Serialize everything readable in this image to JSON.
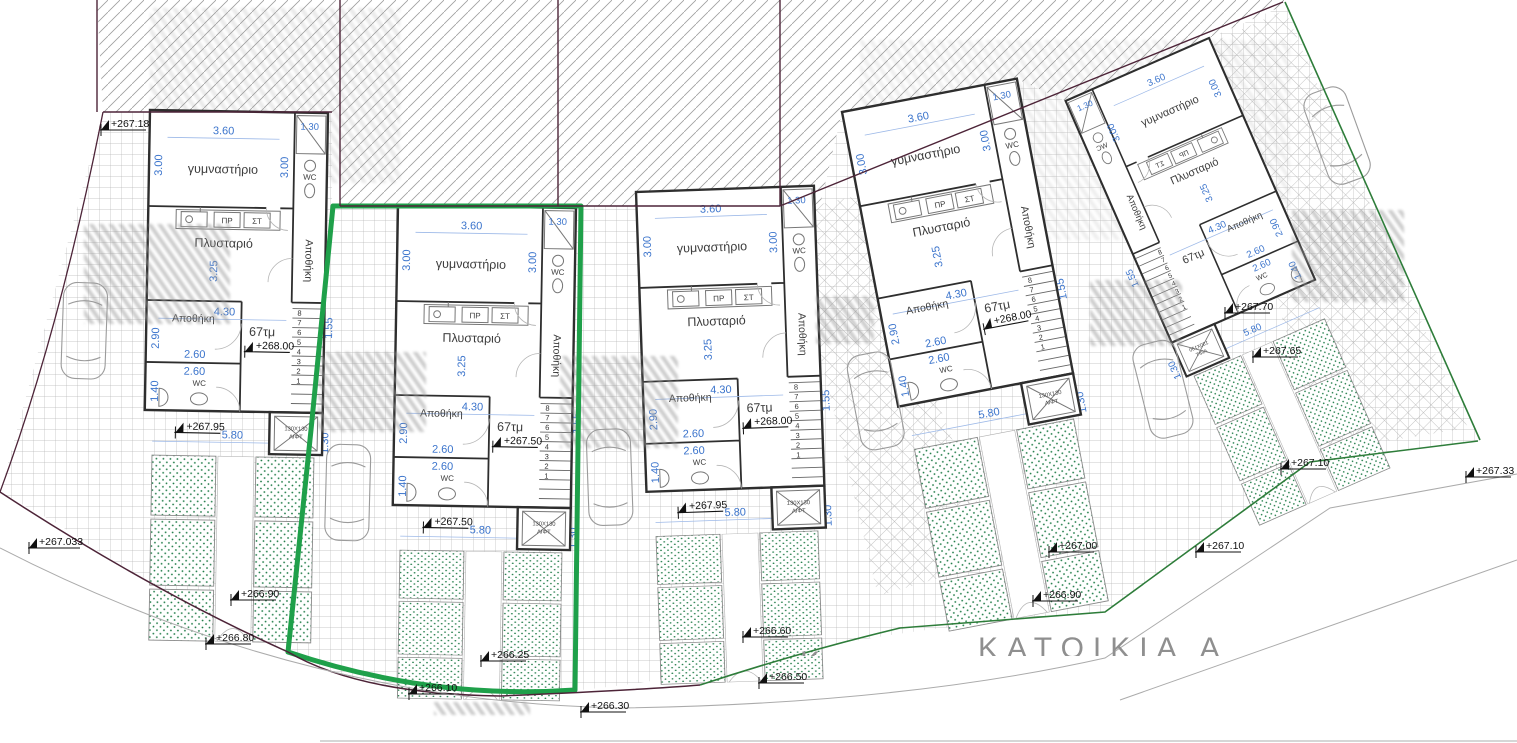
{
  "site": {
    "katoikia_label": "ΚΑΤΟΙΚΙΑ Α",
    "katoikia_partial": "Κ",
    "spot_levels": [
      {
        "label": "+267.18"
      },
      {
        "label": "+267.033"
      },
      {
        "label": "+266.90"
      },
      {
        "label": "+266.80"
      },
      {
        "label": "+266.25"
      },
      {
        "label": "+266.10"
      },
      {
        "label": "+266.30"
      },
      {
        "label": "+266.50"
      },
      {
        "label": "+266.60"
      },
      {
        "label": "+266.90"
      },
      {
        "label": "+267.00"
      },
      {
        "label": "+267.10"
      },
      {
        "label": "+267.10"
      },
      {
        "label": "+267.33"
      },
      {
        "label": "+267.65"
      },
      {
        "label": "+267.70"
      }
    ]
  },
  "unit_template": {
    "gym_label": "γυμναστήριο",
    "laundry_label": "Πλυσταριό",
    "bath_label": "WC",
    "storage_corridor_label": "Αποθήκη",
    "storage_room_label": "Αποθήκη",
    "wc_room_label": "WC",
    "washer_label": "ΠΡ",
    "dryer_label": "ΣΤ",
    "lift_size_label": "130X130",
    "lift_label": "ΛΙΦΤ",
    "area_label": "67τμ",
    "dims": {
      "gym_width": "3.60",
      "gym_depth": "3.00",
      "bath_width": "1.30",
      "bath_depth": "3.00",
      "laundry_depth": "3.25",
      "laundry_width": "4.30",
      "storage_depth": "2.90",
      "storage_width": "2.60",
      "wc_width": "2.60",
      "wc_depth": "1.40",
      "stair_width": "1.55",
      "frontage": "5.80",
      "porch_side": "1.30"
    },
    "stair_numbers": [
      "8",
      "7",
      "6",
      "5",
      "4",
      "3",
      "2",
      "1"
    ]
  },
  "units": [
    {
      "id": "unit-1",
      "interior_level": "+268.00",
      "porch_level": "+267.95",
      "highlighted": false
    },
    {
      "id": "unit-2",
      "interior_level": "+267.50",
      "porch_level": "+267.50",
      "highlighted": true
    },
    {
      "id": "unit-3",
      "interior_level": "+268.00",
      "porch_level": "+267.95",
      "highlighted": false
    },
    {
      "id": "unit-4",
      "interior_level": "+268.00",
      "porch_level": "",
      "highlighted": false
    },
    {
      "id": "unit-5",
      "interior_level": "",
      "porch_level": "",
      "highlighted": false
    }
  ],
  "colors": {
    "highlight_green": "#1fa04a",
    "boundary_green": "#2e7d3a",
    "boundary_maroon": "#4d2438",
    "dimension_blue": "#3b74cc",
    "garden_dot_green": "#1c7a45"
  }
}
